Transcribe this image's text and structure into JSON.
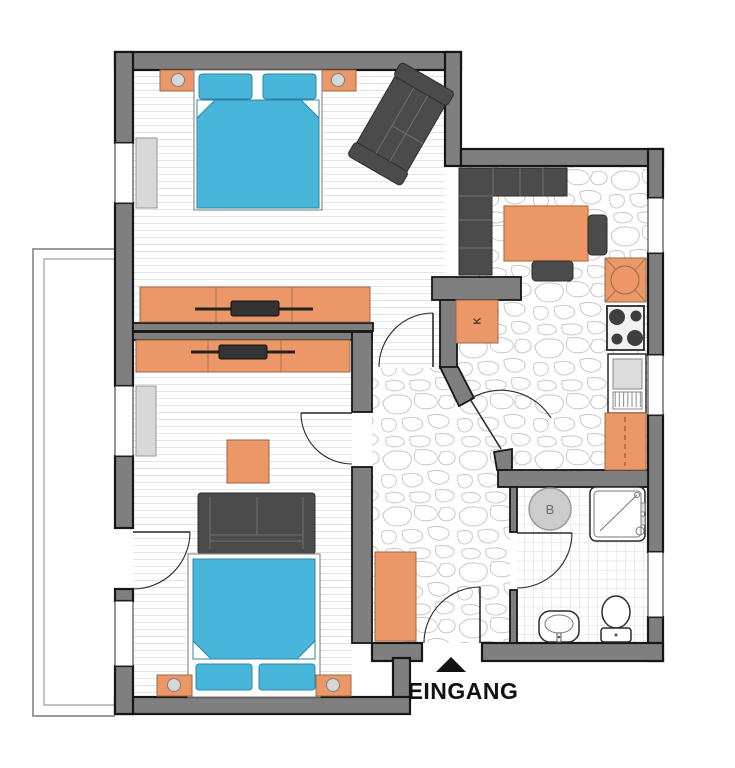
{
  "plan": {
    "labels": {
      "entrance": "EINGANG",
      "closet": "K",
      "boiler": "B"
    }
  },
  "colors": {
    "wall": "#7f7f7f",
    "outline": "#161616",
    "accent": "#ec9768",
    "bed": "#47b6da",
    "dark": "#4b4b4b",
    "window": "#d8d8d8",
    "stone": "#c8c8c8",
    "plank": "#e3e3e3",
    "tile": "#cfcfcf",
    "label": "#111111"
  }
}
